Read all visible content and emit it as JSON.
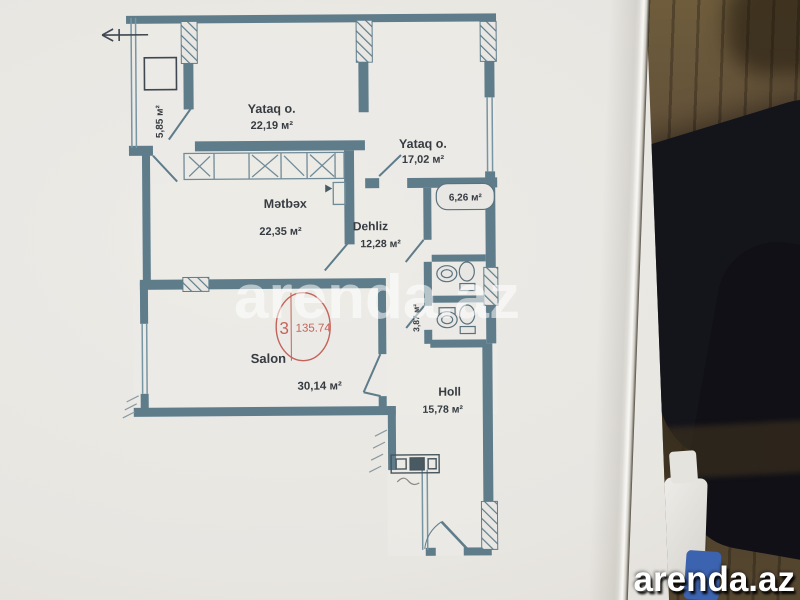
{
  "watermarks": {
    "center": "arenda.az",
    "corner": "arenda.az"
  },
  "stamp": {
    "left_value": "3",
    "right_value": "135.74"
  },
  "rooms": {
    "balcony": {
      "area": "5,85 м²"
    },
    "bedroom1": {
      "name": "Yataq o.",
      "area": "22,19 м²"
    },
    "bedroom2": {
      "name": "Yataq o.",
      "area": "17,02 м²"
    },
    "kitchen": {
      "name": "Mətbəx",
      "area": "22,35 м²"
    },
    "hallway": {
      "name": "Dehliz",
      "area": "12,28 м²"
    },
    "bathroom": {
      "area": "6,26 м²"
    },
    "corridor": {
      "area": "3,87 м²"
    },
    "salon": {
      "name": "Salon",
      "area": "30,14 м²"
    },
    "hall": {
      "name": "Holl",
      "area": "15,78 м²"
    }
  },
  "colors": {
    "wall_teal": "#5e7c8a",
    "paper": "#e8e6e1",
    "stamp_red": "#c0554b",
    "watermark_white": "#ffffff",
    "wood_floor": "#5e4d34",
    "dark_clothing": "#14141b",
    "blue_object": "#3c63b0",
    "label_text": "#363c42"
  }
}
